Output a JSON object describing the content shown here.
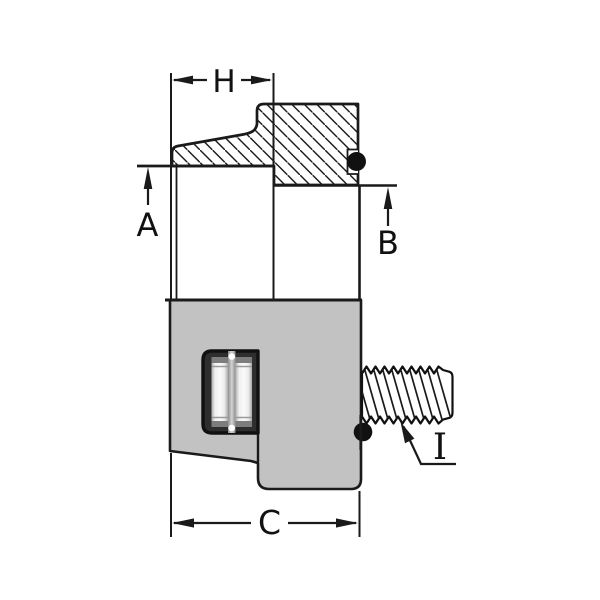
{
  "title": "Threaded fitting cross-section technical drawing",
  "colors": {
    "line": "#1a1a1a",
    "body_fill": "#c2c2c2",
    "o_ring": "#111111",
    "background": "#ffffff",
    "detail_frame": "#2e2e2e"
  },
  "dims": {
    "h": {
      "label": "H"
    },
    "a": {
      "label": "A"
    },
    "b": {
      "label": "B"
    },
    "c": {
      "label": "C"
    },
    "i": {
      "label": "I"
    }
  }
}
